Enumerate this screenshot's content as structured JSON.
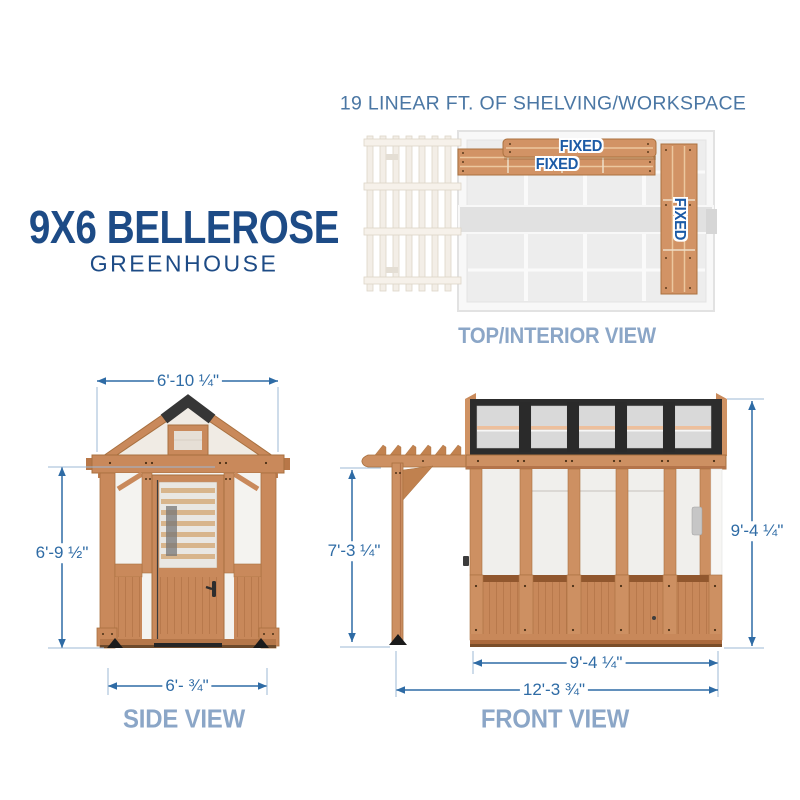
{
  "header": {
    "shelving_note": "19 LINEAR FT. OF SHELVING/WORKSPACE"
  },
  "title": {
    "line1": "9X6 BELLEROSE",
    "line2": "GREENHOUSE"
  },
  "top_view": {
    "caption": "TOP/INTERIOR VIEW",
    "shelves": [
      {
        "position": "upper-back",
        "label": "FIXED"
      },
      {
        "position": "lower-back",
        "label": "FIXED"
      },
      {
        "position": "right-side",
        "label": "FIXED"
      }
    ]
  },
  "side_view": {
    "caption": "SIDE VIEW",
    "dimensions": {
      "roof_width": "6'-10 ¼\"",
      "wall_height": "6'-9 ½\"",
      "base_width": "6'- ¾\""
    }
  },
  "front_view": {
    "caption": "FRONT VIEW",
    "dimensions": {
      "pergola_height": "7'-3 ¼\"",
      "overall_height": "9'-4 ¼\"",
      "greenhouse_width": "9'-4 ¼\"",
      "overall_width": "12'-3 ¾\""
    }
  },
  "colors": {
    "dimension_blue": "#2e6ba5",
    "title_navy": "#1d4b86",
    "caption_blue": "#8ba6c7",
    "heading_blue": "#4b77a4",
    "fixed_label_blue": "#1c5ba6",
    "wood": "#cd9062",
    "wood_outline": "#a8703f",
    "roof_black": "#2c2c2c"
  }
}
